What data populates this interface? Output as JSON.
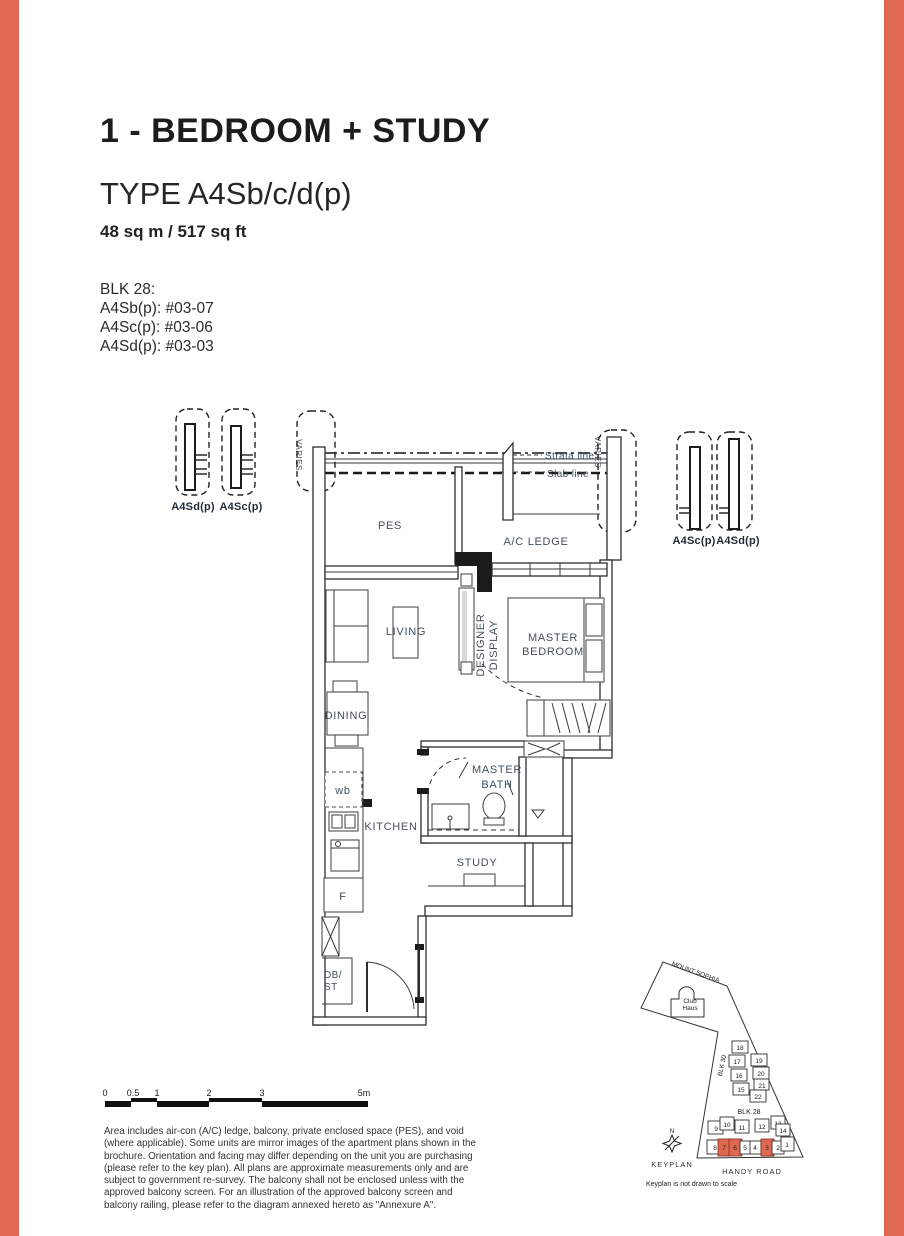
{
  "page": {
    "border_color": "#df6950",
    "highlight_color": "#df6950"
  },
  "header": {
    "title": "1 - BEDROOM + STUDY",
    "type_label": "TYPE A4Sb/c/d(p)",
    "area": "48 sq m / 517 sq ft",
    "block_heading": "BLK 28:",
    "units": [
      "A4Sb(p): #03-07",
      "A4Sc(p): #03-06",
      "A4Sd(p): #03-03"
    ]
  },
  "floorplan": {
    "rooms": {
      "pes": "PES",
      "ac_ledge": "A/C LEDGE",
      "living": "LIVING",
      "dining": "DINING",
      "master_bedroom": [
        "MASTER",
        "BEDROOM"
      ],
      "designer_display": [
        "DESIGNER",
        "DISPLAY"
      ],
      "master_bath": [
        "MASTER",
        "BATH"
      ],
      "kitchen": "KITCHEN",
      "study": "STUDY",
      "washer": "wb",
      "fridge": "F",
      "db_st": [
        "DB/",
        "ST"
      ]
    },
    "annotations": {
      "strata": "Strata line",
      "slab": "Slab line",
      "varies": "VARIES"
    },
    "screen_icons": {
      "left": [
        "A4Sd(p)",
        "A4Sc(p)"
      ],
      "right": [
        "A4Sc(p)",
        "A4Sd(p)"
      ]
    }
  },
  "scale_bar": {
    "ticks": [
      "0",
      "0.5",
      "1",
      "2",
      "3",
      "5m"
    ]
  },
  "disclaimer": "Area includes air-con (A/C) ledge, balcony, private enclosed space (PES), and void (where applicable). Some units are mirror images of the apartment plans shown in the brochure. Orientation and facing may differ depending on the unit you are purchasing (please refer to the key plan). All plans are approximate measurements only and are subject to government re-survey. The balcony shall not be enclosed unless with the approved balcony screen. For an illustration of the approved balcony screen and balcony railing, please refer to the diagram annexed hereto as \"Annexure A\".",
  "keyplan": {
    "title": "KEYPLAN",
    "note": "Keyplan is not drawn to scale",
    "road_top": "MOUNT SOPHIA",
    "road_bottom": "HANDY ROAD",
    "club_haus": [
      "Club",
      "Haus"
    ],
    "blk30_label": "BLK 30",
    "blk28_label": "BLK 28",
    "blk30_units": [
      "18",
      "17",
      "16",
      "15",
      "19",
      "20",
      "21",
      "22"
    ],
    "blk28_units": [
      "9",
      "10",
      "11",
      "12",
      "13",
      "14",
      "8",
      "7",
      "6",
      "5",
      "4",
      "3",
      "2",
      "1"
    ],
    "highlighted_units": [
      "7",
      "6",
      "3"
    ],
    "north_label": "N"
  }
}
